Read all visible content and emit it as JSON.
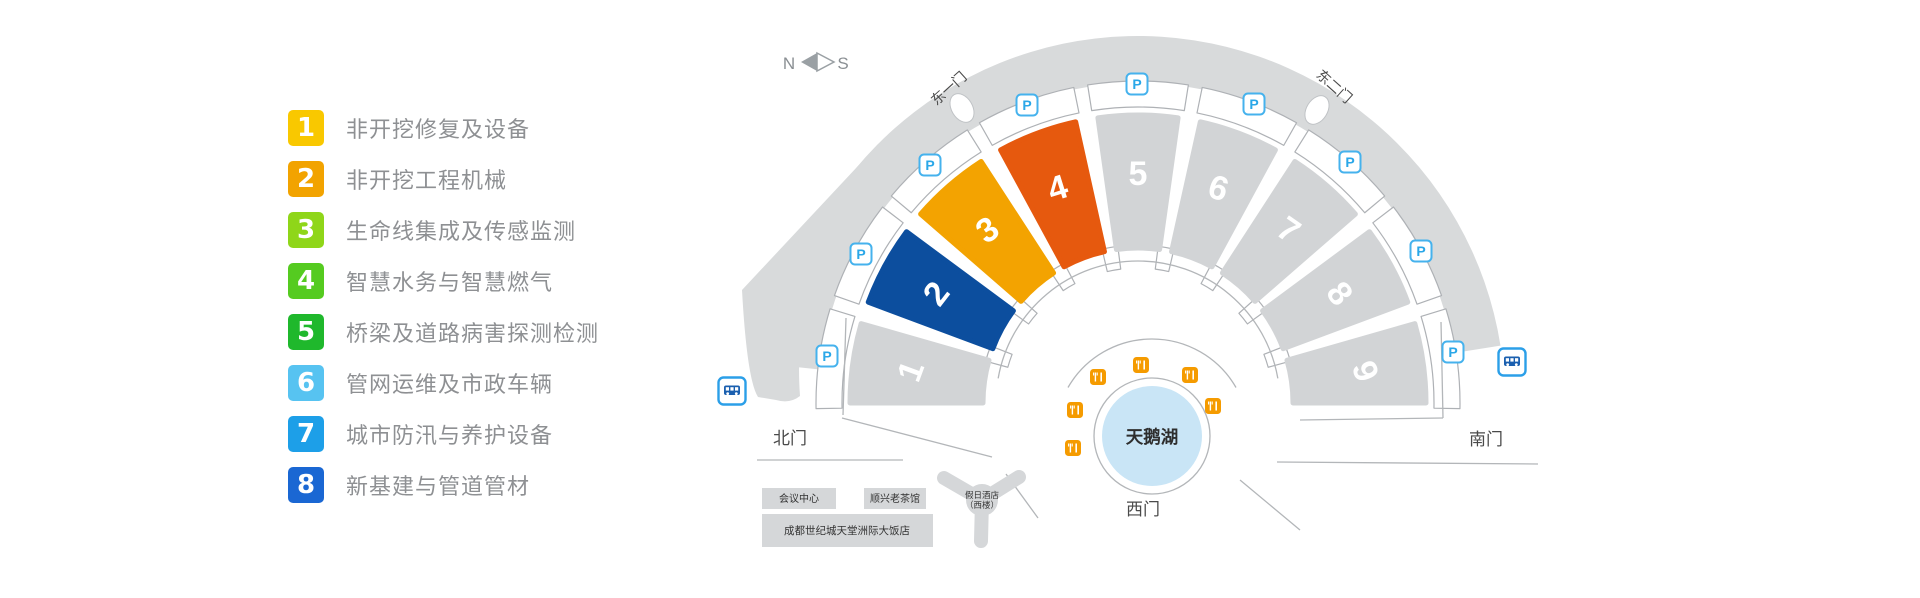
{
  "legend": {
    "items": [
      {
        "num": "1",
        "label": "非开挖修复及设备",
        "color": "#F9C800"
      },
      {
        "num": "2",
        "label": "非开挖工程机械",
        "color": "#F2A300"
      },
      {
        "num": "3",
        "label": "生命线集成及传感监测",
        "color": "#8FD619"
      },
      {
        "num": "4",
        "label": "智慧水务与智慧燃气",
        "color": "#55CB20"
      },
      {
        "num": "5",
        "label": "桥梁及道路病害探测检测",
        "color": "#1FB82C"
      },
      {
        "num": "6",
        "label": "管网运维及市政车辆",
        "color": "#57C3F1"
      },
      {
        "num": "7",
        "label": "城市防汛与养护设备",
        "color": "#1D9FE8"
      },
      {
        "num": "8",
        "label": "新基建与管道管材",
        "color": "#1A67D3"
      }
    ]
  },
  "compass": {
    "north": "N",
    "south": "S"
  },
  "map": {
    "colors": {
      "ring": "#D8DADB",
      "hall_gray": "#D2D4D6",
      "outline": "#AEB1B5",
      "road": "#B3B6B9",
      "building": "#D5D7D9",
      "lake": "#C9E5F6",
      "parking_blue": "#2AA7E8",
      "bus_blue": "#1A5FAF",
      "bus_border": "#2B9FE8",
      "restaurant_orange": "#F59B00"
    },
    "halls": [
      {
        "number": "1",
        "color": "#D2D4D6"
      },
      {
        "number": "2",
        "color": "#0C4E9E"
      },
      {
        "number": "3",
        "color": "#F3A301"
      },
      {
        "number": "4",
        "color": "#E6590E"
      },
      {
        "number": "5",
        "color": "#D2D4D6"
      },
      {
        "number": "6",
        "color": "#D2D4D6"
      },
      {
        "number": "7",
        "color": "#D2D4D6"
      },
      {
        "number": "8",
        "color": "#D2D4D6"
      },
      {
        "number": "9",
        "color": "#D2D4D6"
      }
    ],
    "gates": {
      "east1": "东一门",
      "east2": "东二门",
      "north": "北门",
      "south": "南门",
      "west": "西门"
    },
    "lake": {
      "label": "天鹅湖"
    },
    "buildings": [
      {
        "label": "会议中心"
      },
      {
        "label": "顺兴老茶馆"
      },
      {
        "label": "成都世纪城天堂洲际大饭店"
      },
      {
        "label": "假日酒店",
        "label2": "（西楼）"
      }
    ],
    "icons": {
      "parking": {
        "glyph": "P",
        "positions": [
          [
            930,
            165
          ],
          [
            1027,
            105
          ],
          [
            1137,
            84
          ],
          [
            1254,
            104
          ],
          [
            1350,
            162
          ],
          [
            861,
            254
          ],
          [
            827,
            356
          ],
          [
            1421,
            251
          ],
          [
            1453,
            352
          ]
        ]
      },
      "bus": {
        "positions": [
          [
            732,
            391
          ],
          [
            1512,
            362
          ]
        ]
      },
      "restaurant": {
        "positions": [
          [
            1141,
            365
          ],
          [
            1098,
            377
          ],
          [
            1190,
            375
          ],
          [
            1075,
            410
          ],
          [
            1213,
            406
          ],
          [
            1073,
            448
          ]
        ]
      }
    }
  }
}
